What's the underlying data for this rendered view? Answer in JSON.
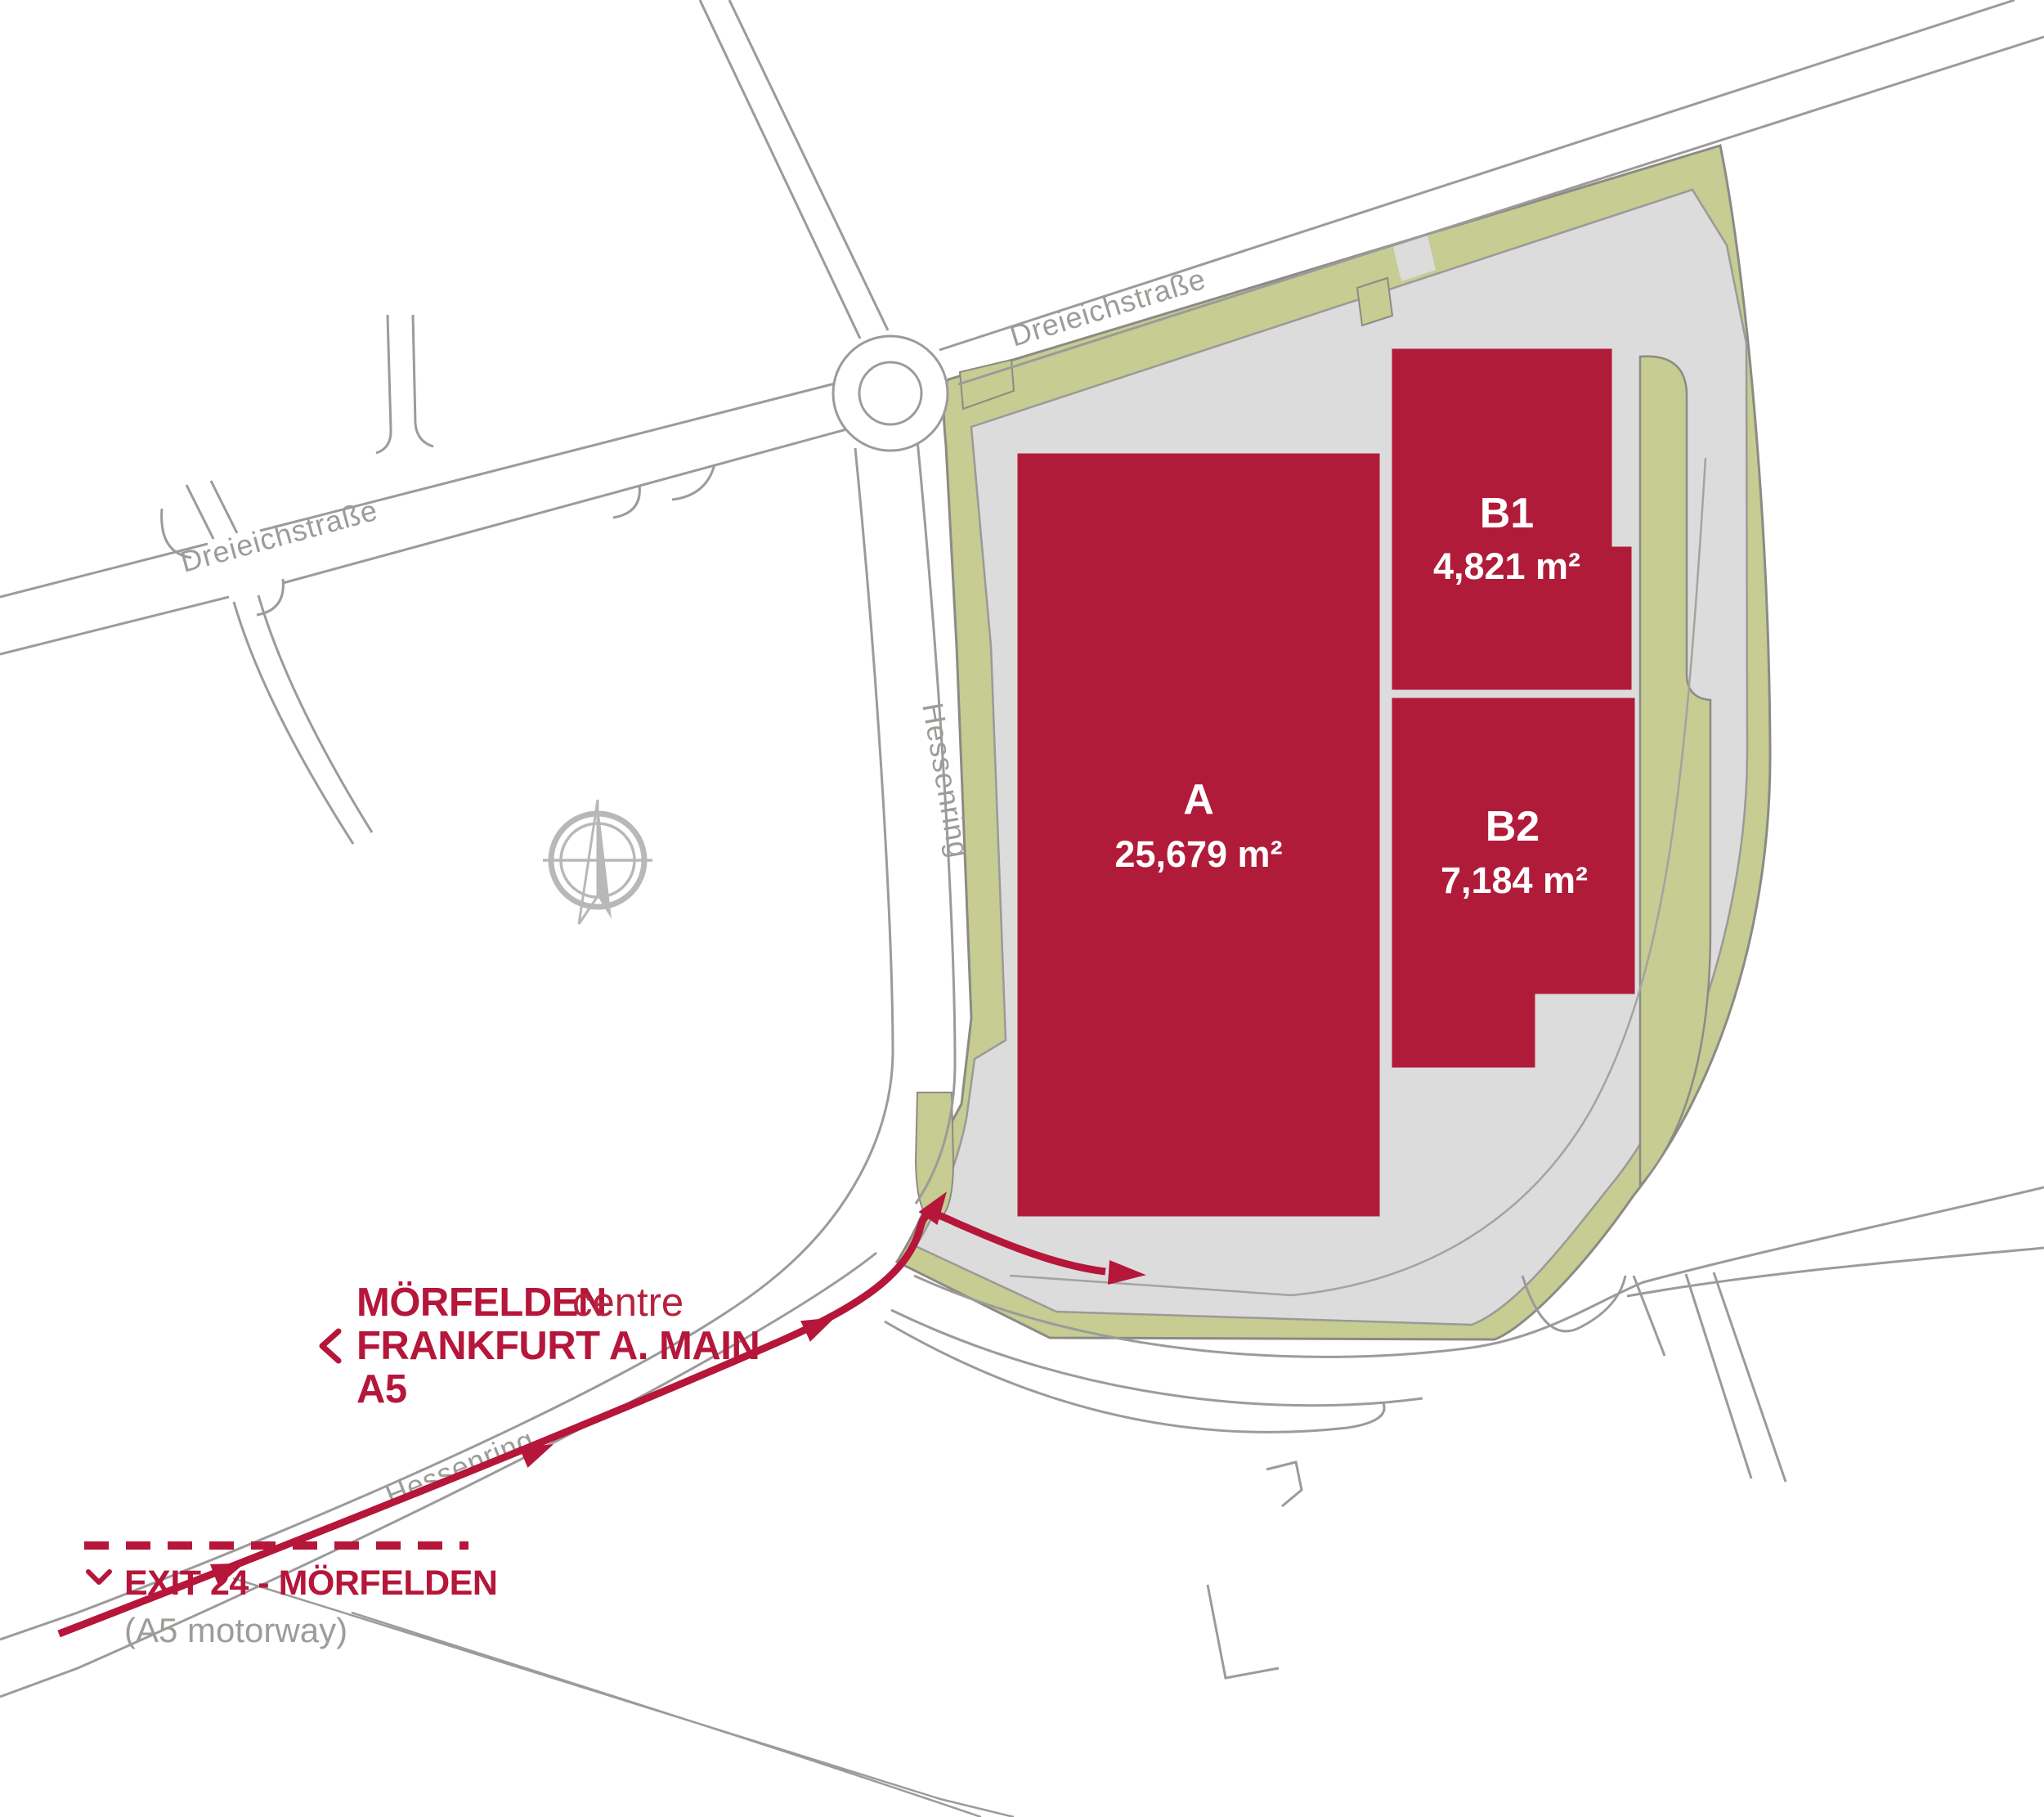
{
  "map": {
    "title": "Site plan Mörfelden logistics plots",
    "streets": {
      "dreieichstrasse_top": "Dreieichstraße",
      "dreieichstrasse_left": "Dreieichstraße",
      "hessenring_center": "Hessenring",
      "hessenring_bottom": "Hessenring"
    },
    "buildings": [
      {
        "label": "A",
        "area": "25,679 m²"
      },
      {
        "label": "B1",
        "area": "4,821 m²"
      },
      {
        "label": "B2",
        "area": "7,184 m²"
      }
    ],
    "directions": {
      "destination_primary": "MÖRFELDEN",
      "destination_primary_suffix": "centre",
      "destination_secondary": "FRANKFURT A. MAIN",
      "destination_motorway": "A5",
      "exit_label": "EXIT 24 - MÖRFELDEN",
      "exit_note": "(A5 motorway)"
    },
    "colors": {
      "building_red": "#b11b3a",
      "accent_red": "#b5163a",
      "green": "#c6cc92",
      "site_gray": "#dcdcdc",
      "road_line": "#9b9b9b",
      "muted_text": "#9c9c98",
      "compass_gray": "#b8b8b8"
    }
  }
}
